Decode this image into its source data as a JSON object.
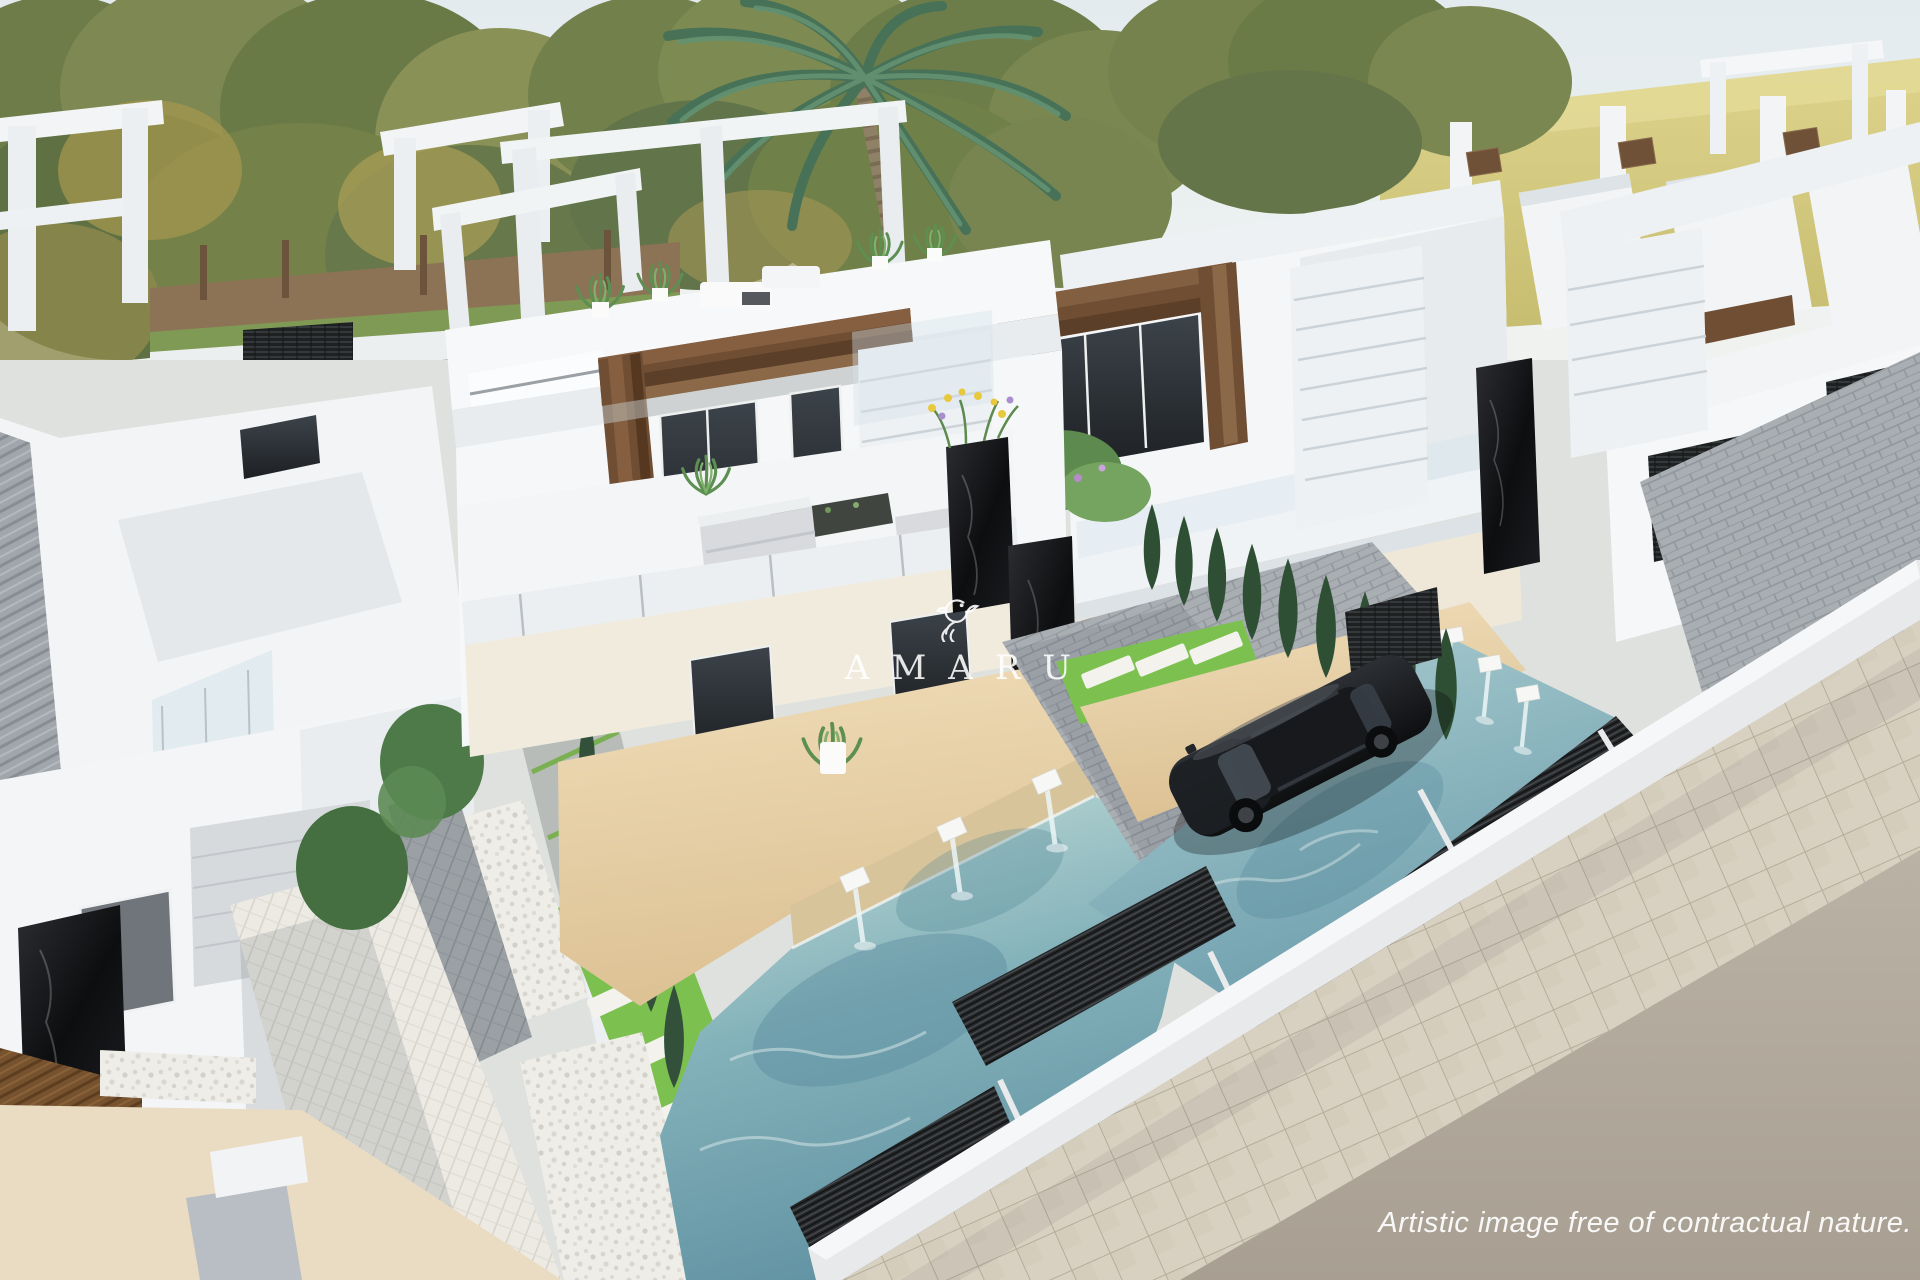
{
  "watermark": {
    "brand": "AMARU",
    "icon": "hummingbird-icon"
  },
  "caption": {
    "text": "Artistic image free of contractual nature."
  },
  "palette": {
    "sky": "#e9eff1",
    "field": "#d2c77b",
    "foliage_green": "#75814d",
    "foliage_autumn": "#a5975a",
    "palm_green": "#4f7c60",
    "villa_white": "#f4f6f7",
    "villa_shadow": "#d7dde2",
    "wood_brown": "#6f5138",
    "marble_black": "#17181a",
    "glass_dark": "#272b30",
    "water_teal": "#8fbcc4",
    "water_deep": "#61929f",
    "grass": "#7cc04f",
    "deck_tan": "#e6cda4",
    "pavers_white": "#edece6",
    "pavers_grey": "#9aa0a5",
    "pebbles": "#efeeea",
    "fence_dark": "#242628",
    "road_grey": "#b2aa9d",
    "sidewalk_beige": "#d8d1c1",
    "car_black": "#1a1c1f"
  },
  "scene": {
    "elements": [
      "villas",
      "pools",
      "palm-tree",
      "car",
      "road",
      "sidewalk",
      "gardens"
    ]
  }
}
